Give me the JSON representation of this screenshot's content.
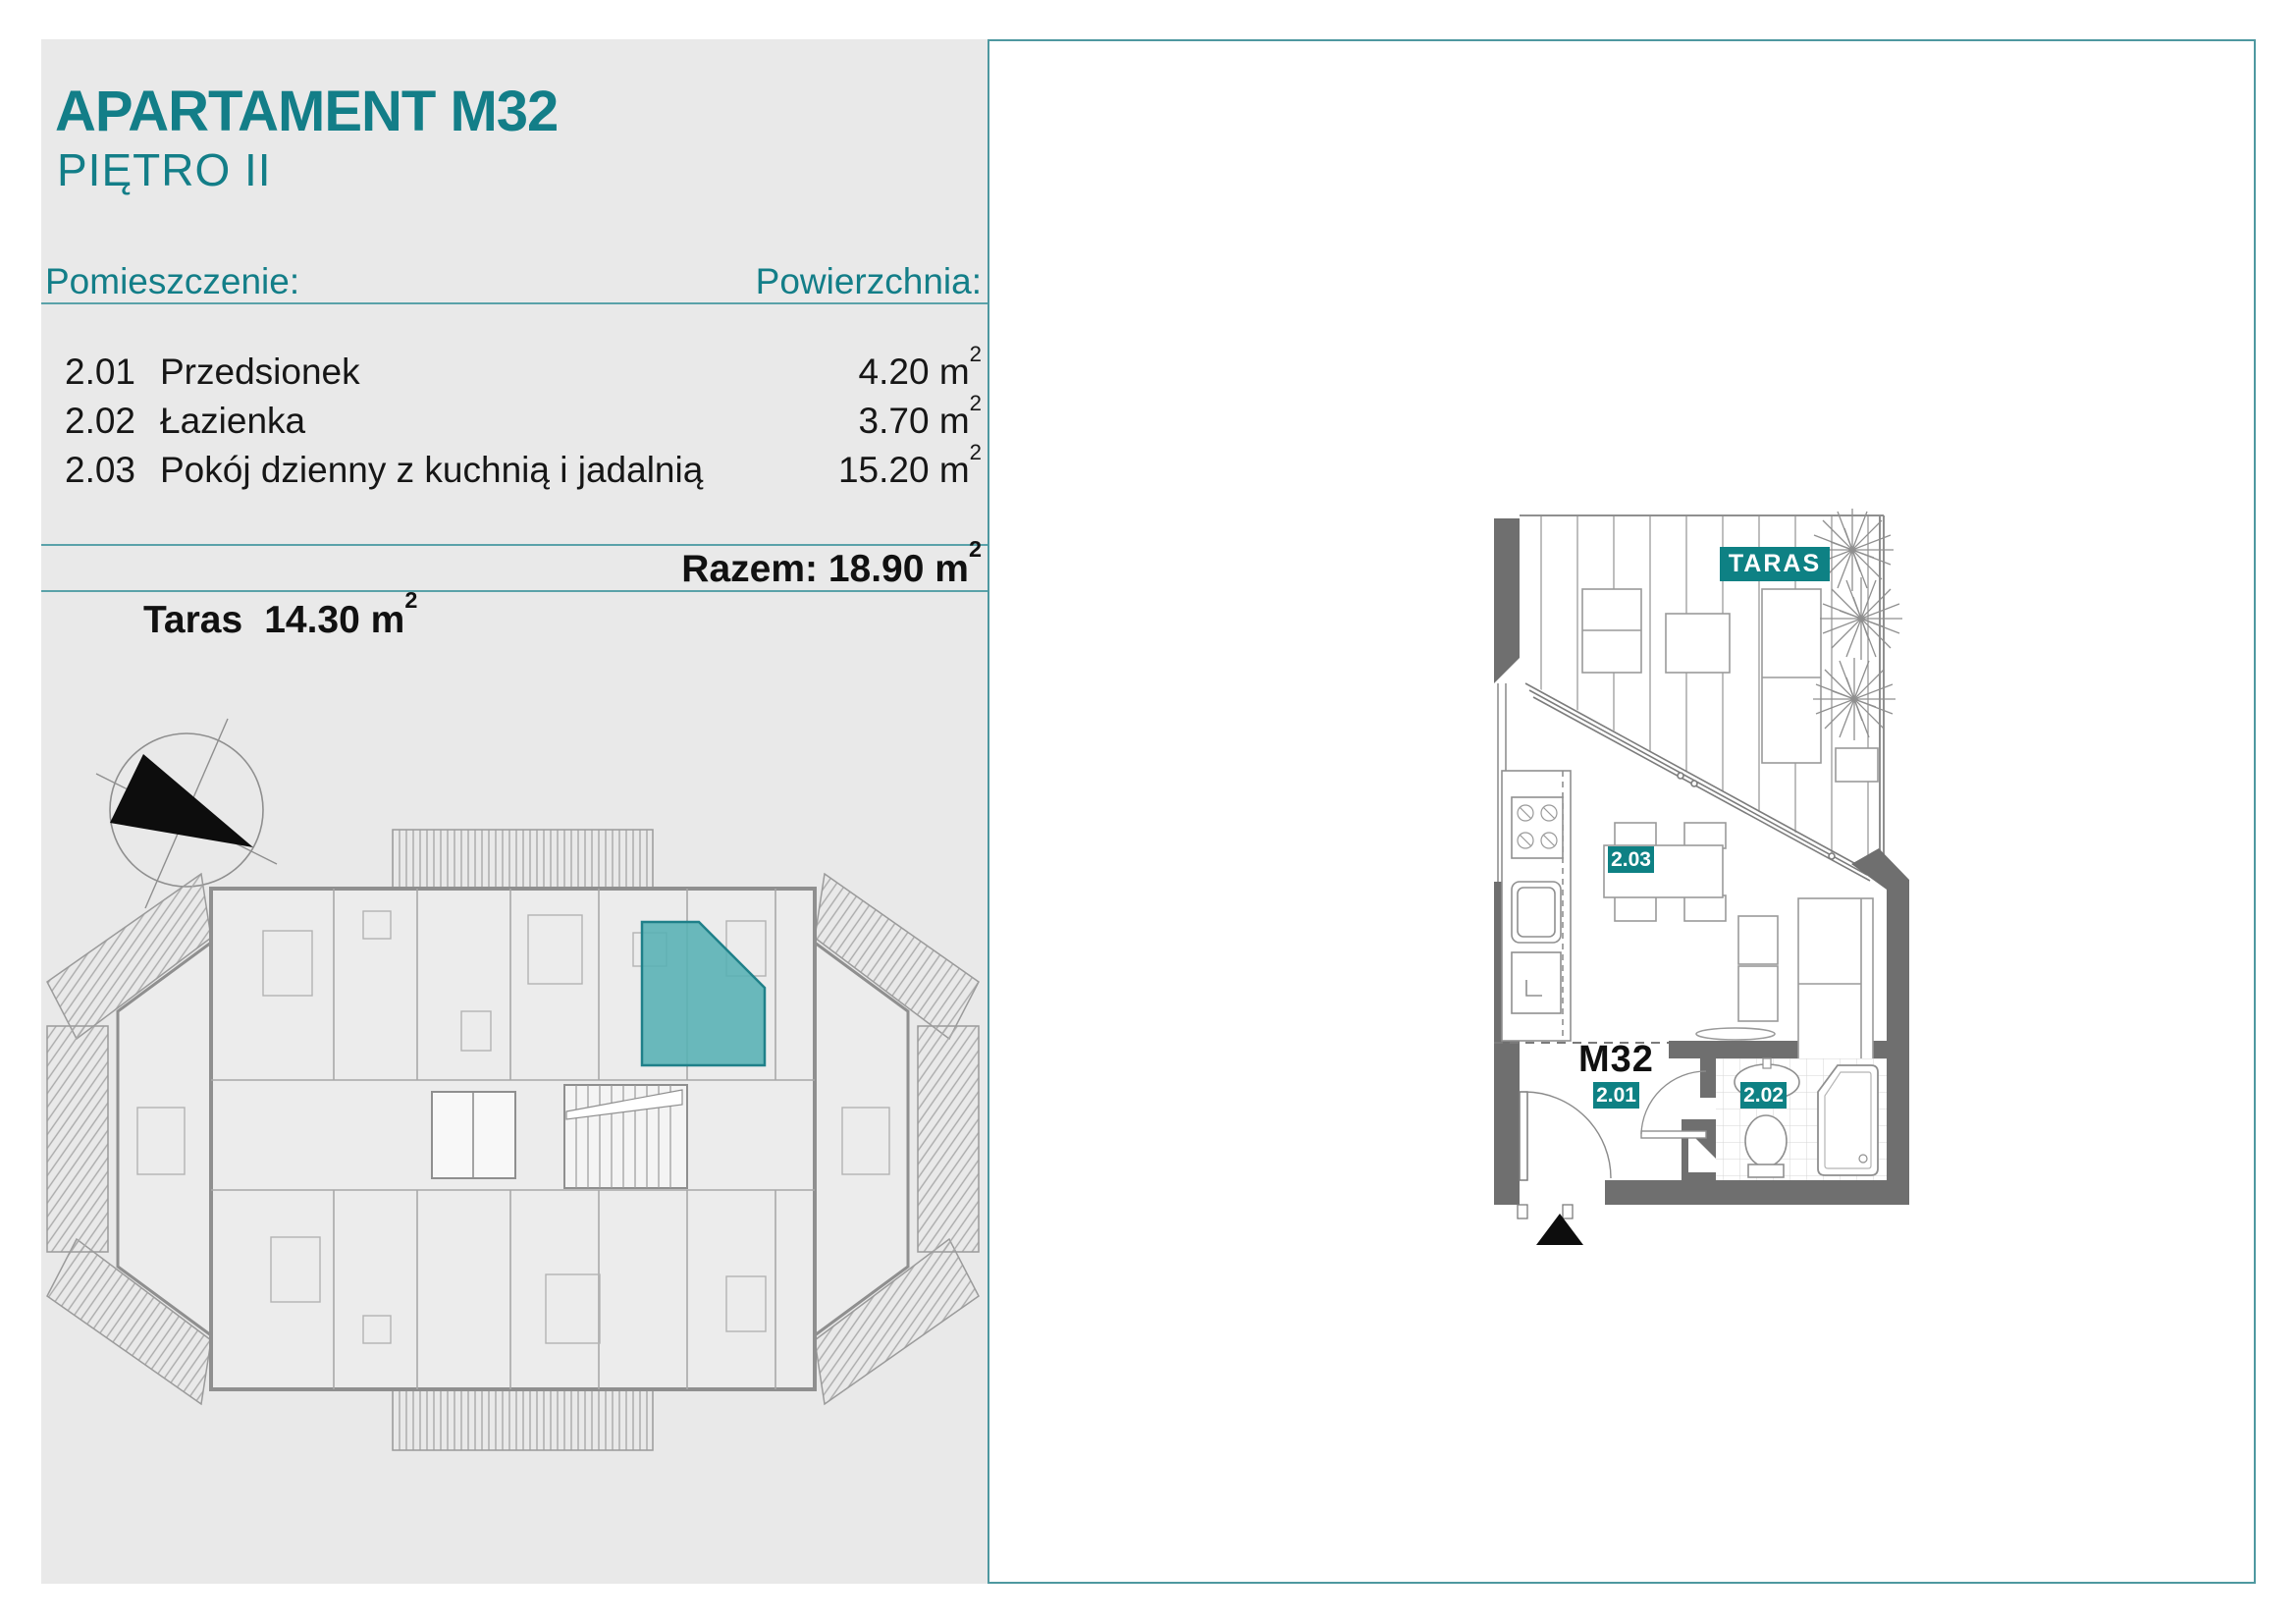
{
  "header": {
    "title": "APARTAMENT M32",
    "subtitle": "PIĘTRO II"
  },
  "table": {
    "col_room": "Pomieszczenie:",
    "col_area": "Powierzchnia:",
    "rows": [
      {
        "no": "2.01",
        "name": "Przedsionek",
        "area": "4.20"
      },
      {
        "no": "2.02",
        "name": "Łazienka",
        "area": "3.70"
      },
      {
        "no": "2.03",
        "name": "Pokój dzienny z kuchnią i jadalnią",
        "area": "15.20"
      }
    ],
    "unit": "m",
    "sup": "2",
    "total_label": "Razem:",
    "total_value": "18.90",
    "terrace_label": "Taras",
    "terrace_value": "14.30"
  },
  "plan": {
    "taras": "TARAS",
    "m32": "M32",
    "r201": "2.01",
    "r202": "2.02",
    "r203": "2.03"
  },
  "colors": {
    "teal_text": "#137e88",
    "teal_chip": "#0e8184",
    "highlight_unit": "#57b0b4",
    "panel_bg": "#e9e9e9",
    "rule": "#5aa2a9",
    "wall_gray": "#6f6f6f"
  }
}
